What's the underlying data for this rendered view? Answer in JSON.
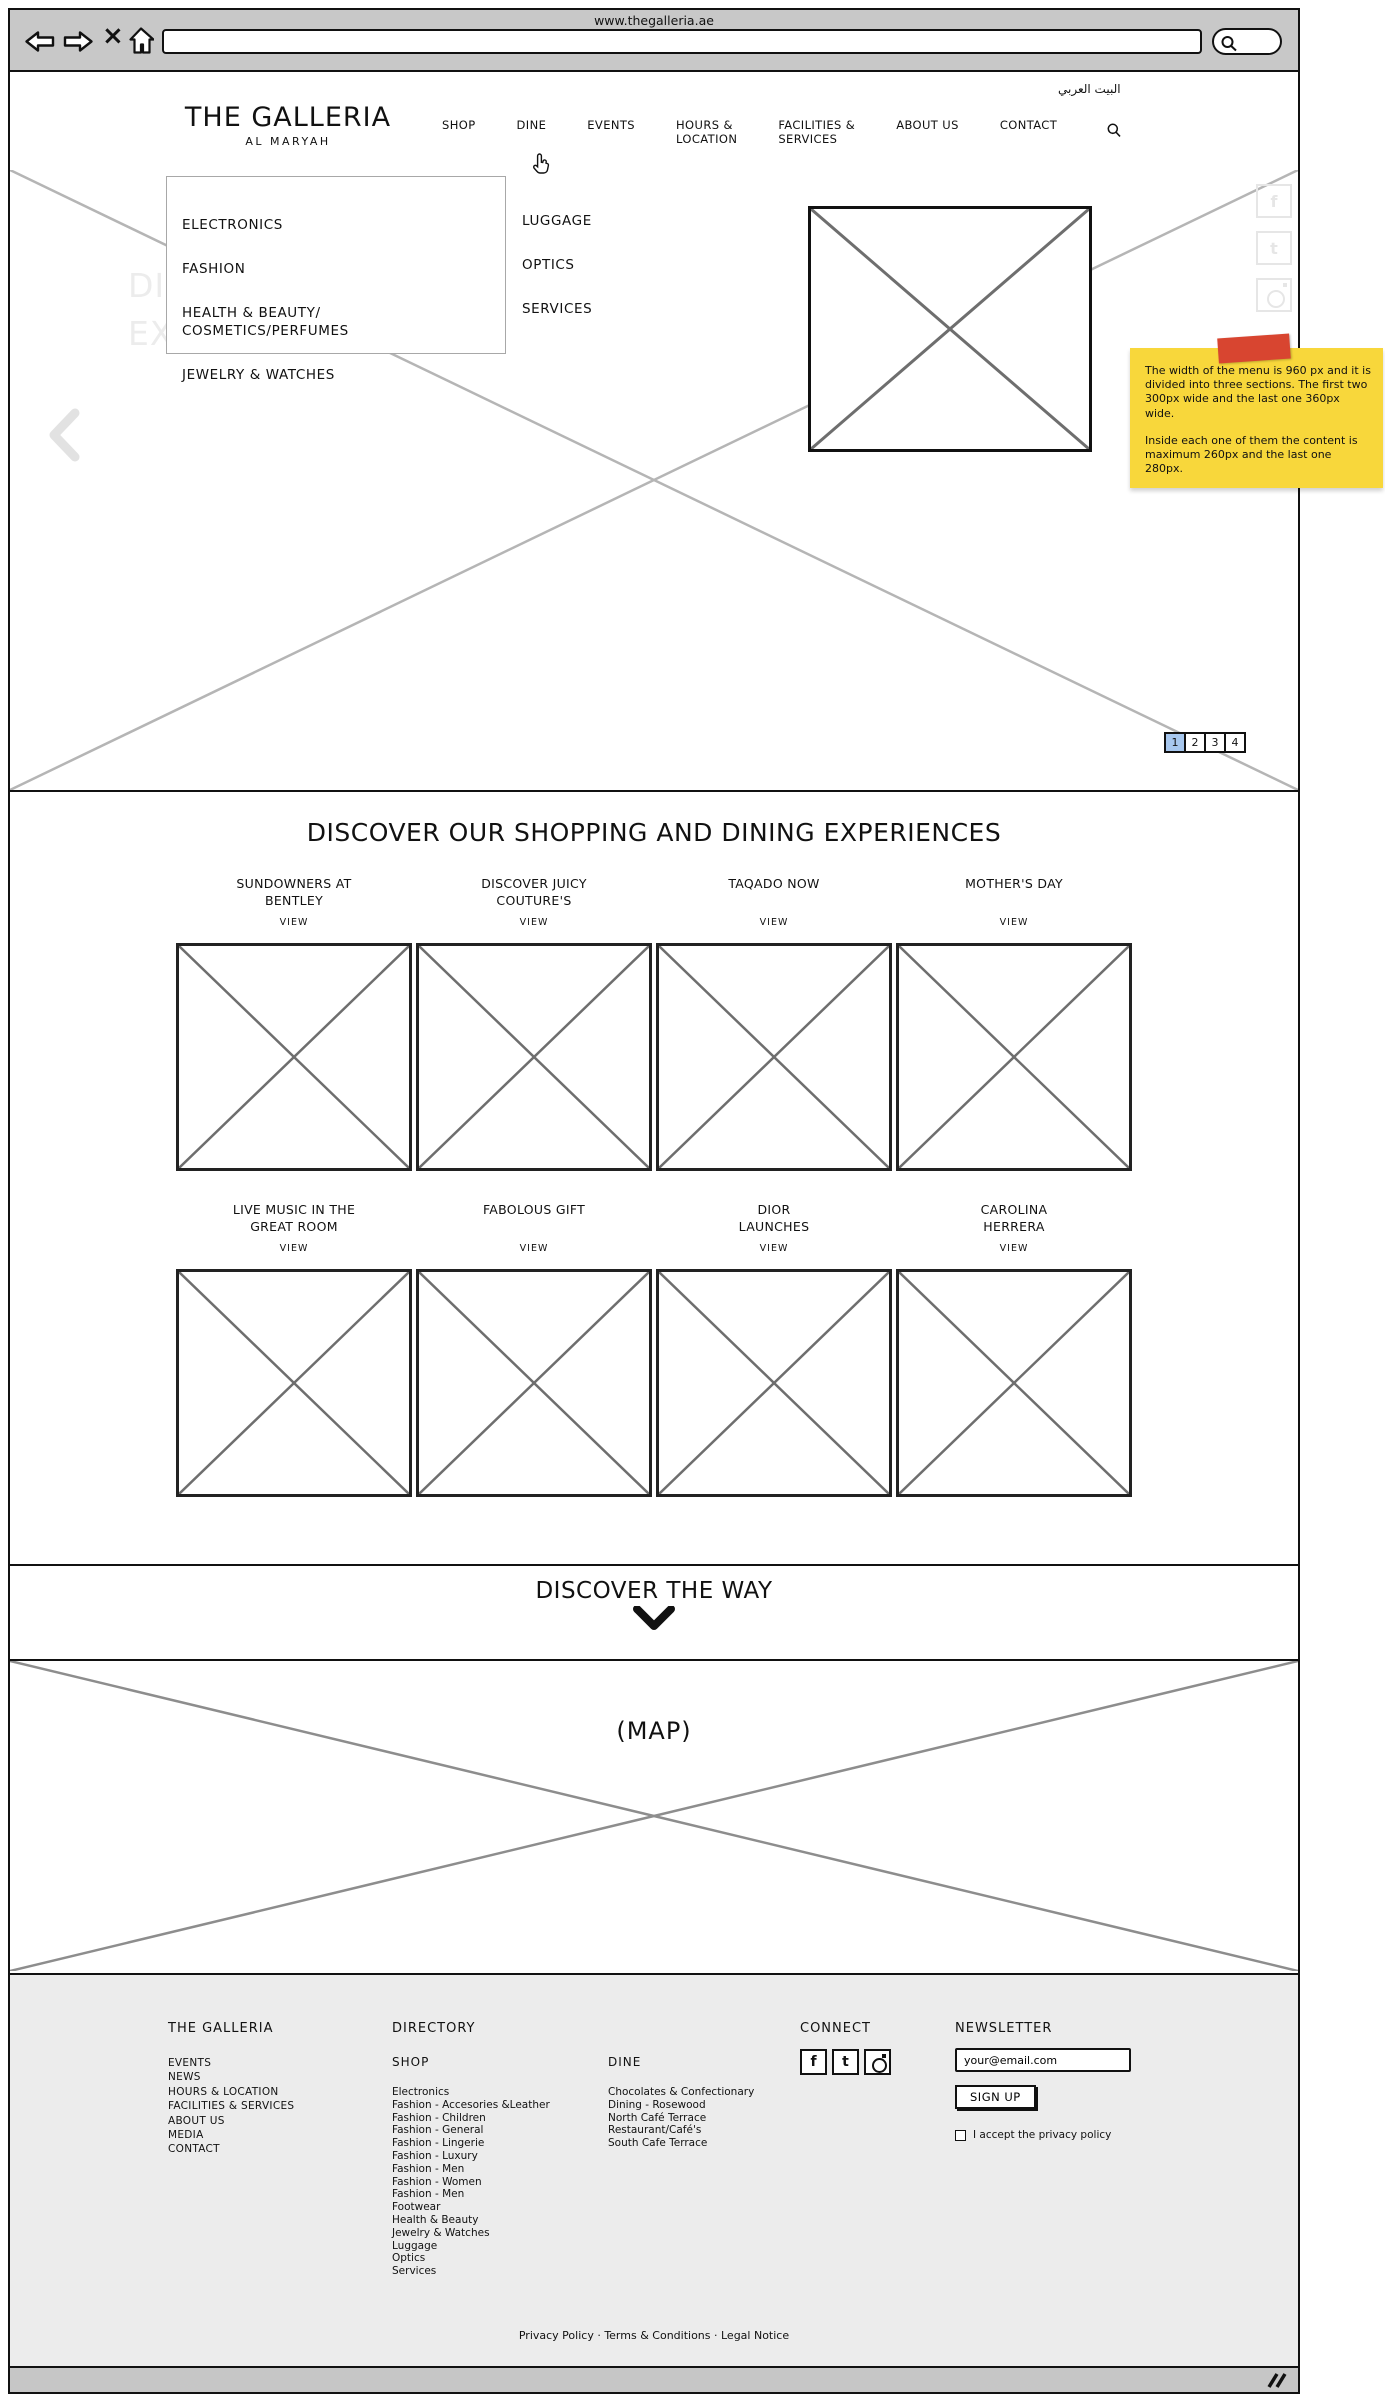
{
  "browser": {
    "page_title": "www.thegalleria.ae",
    "icons": {
      "stop_glyph": "×"
    }
  },
  "header": {
    "logo_title": "THE GALLERIA",
    "logo_subtitle": "AL MARYAH",
    "language_link": "البيت العربي",
    "nav": [
      "SHOP",
      "DINE",
      "EVENTS",
      "HOURS &\nLOCATION",
      "FACILITIES &\nSERVICES",
      "ABOUT US",
      "CONTACT"
    ]
  },
  "mega_menu": {
    "column1": [
      "ELECTRONICS",
      "FASHION",
      "HEALTH & BEAUTY/\nCOSMETICS/PERFUMES",
      "JEWELRY & WATCHES"
    ],
    "column2": [
      "LUGGAGE",
      "OPTICS",
      "SERVICES"
    ]
  },
  "hero": {
    "watermark": "DISCOVER THE\nEXTRAORDINARY",
    "pagination": [
      "1",
      "2",
      "3",
      "4"
    ],
    "pagination_active_index": 0,
    "pagination_active_color": "#a7c7ee",
    "side_social_icons": [
      "facebook",
      "twitter",
      "instagram"
    ]
  },
  "social": {
    "facebook_glyph": "f",
    "twitter_glyph": "t"
  },
  "annotation_note": {
    "line1": "The width of the menu is 960 px and it is divided into three sections. The first two 300px wide and the last one 360px wide.",
    "line2": "Inside each one of them the content is maximum 260px and the last one 280px.",
    "note_color": "#f8d73b",
    "tape_color": "#d84530"
  },
  "experiences": {
    "heading": "DISCOVER OUR SHOPPING AND DINING EXPERIENCES",
    "view_label": "VIEW",
    "cards": [
      {
        "title": "SUNDOWNERS AT\nBENTLEY"
      },
      {
        "title": "DISCOVER JUICY\nCOUTURE'S"
      },
      {
        "title": "TAQADO NOW"
      },
      {
        "title": "MOTHER'S DAY"
      },
      {
        "title": "LIVE MUSIC IN THE\nGREAT ROOM"
      },
      {
        "title": "FABOLOUS GIFT"
      },
      {
        "title": "DIOR\nLAUNCHES"
      },
      {
        "title": "CAROLINA\nHERRERA"
      }
    ]
  },
  "way": {
    "heading": "DISCOVER THE WAY"
  },
  "map": {
    "label": "(MAP)"
  },
  "footer": {
    "galleria": {
      "heading": "THE GALLERIA",
      "links": [
        "EVENTS",
        "NEWS",
        "HOURS & LOCATION",
        "FACILITIES & SERVICES",
        "ABOUT US",
        "MEDIA",
        "CONTACT"
      ]
    },
    "directory": {
      "heading": "DIRECTORY",
      "shop": {
        "heading": "SHOP",
        "links": [
          "Electronics",
          "Fashion - Accesories &Leather",
          "Fashion - Children",
          "Fashion - General",
          "Fashion - Lingerie",
          "Fashion - Luxury",
          "Fashion - Men",
          "Fashion - Women",
          "Fashion - Men",
          "Footwear",
          "Health & Beauty",
          "Jewelry & Watches",
          "Luggage",
          "Optics",
          "Services"
        ]
      },
      "dine": {
        "heading": "DINE",
        "links": [
          "Chocolates & Confectionary",
          "Dining - Rosewood",
          "North Café Terrace",
          "Restaurant/Café's",
          "South Cafe Terrace"
        ]
      }
    },
    "connect": {
      "heading": "CONNECT",
      "icons": [
        "facebook",
        "twitter",
        "instagram"
      ]
    },
    "newsletter": {
      "heading": "NEWSLETTER",
      "email_value": "your@email.com",
      "signup_label": "SIGN UP",
      "privacy_label": "I accept the privacy policy"
    },
    "legal_text": "Privacy Policy · Terms & Conditions · Legal Notice"
  }
}
